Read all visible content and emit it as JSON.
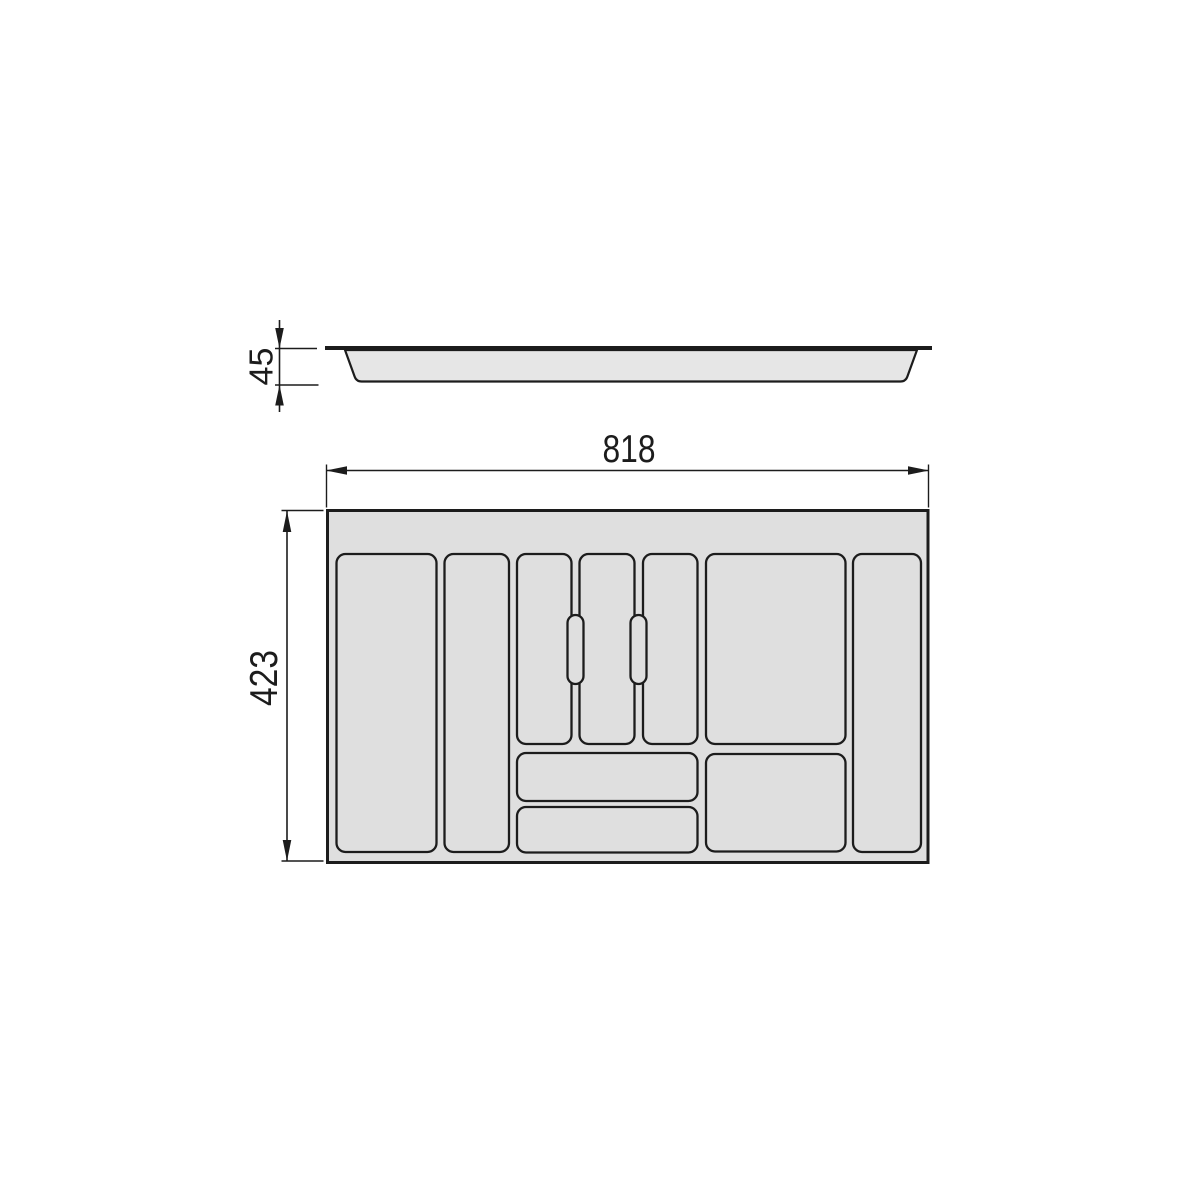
{
  "drawing": {
    "type": "technical-drawing-cutlery-tray",
    "dimensions": {
      "height": "45",
      "width": "818",
      "depth": "423"
    },
    "colors": {
      "background": "#ffffff",
      "line": "#1c1c1c",
      "tray_fill": "#dfdfdf",
      "profile_fill": "#e6e6e6"
    }
  }
}
